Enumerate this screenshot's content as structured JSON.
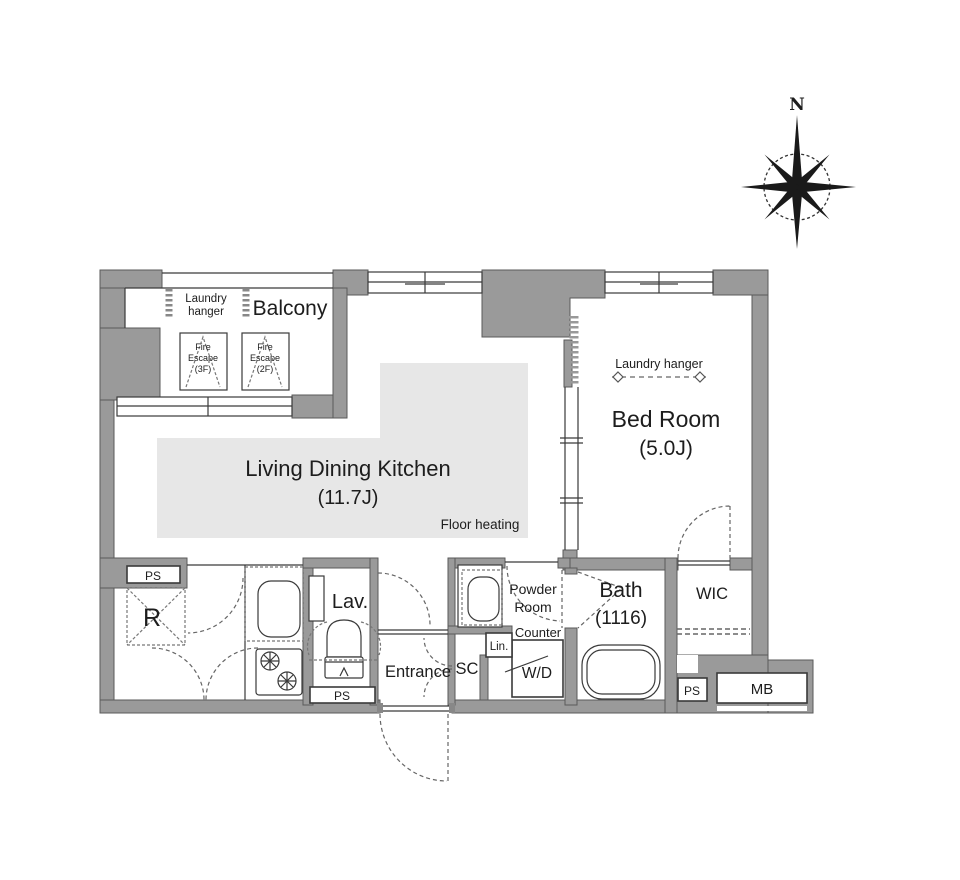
{
  "compass": {
    "north_label": "N"
  },
  "colors": {
    "wall": "#9a9a9a",
    "floor_heating": "#e7e7e7",
    "line": "#3a3a3a"
  },
  "balcony": {
    "label": "Balcony",
    "laundry_line1": "Laundry",
    "laundry_line2": "hanger",
    "fire_escape_3f": {
      "line1": "Fire",
      "line2": "Escape",
      "line3": "(3F)"
    },
    "fire_escape_2f": {
      "line1": "Fire",
      "line2": "Escape",
      "line3": "(2F)"
    }
  },
  "ldk": {
    "name": "Living Dining Kitchen",
    "size": "(11.7J)",
    "floor_heating": "Floor heating"
  },
  "bedroom": {
    "name": "Bed Room",
    "size": "(5.0J)",
    "laundry_hanger": "Laundry hanger"
  },
  "rooms": {
    "lav": "Lav.",
    "entrance": "Entrance",
    "sc": "SC",
    "lin": "Lin.",
    "powder_line1": "Powder",
    "powder_line2": "Room",
    "counter": "Counter",
    "wd": "W/D",
    "bath": "Bath",
    "bath_size": "(1116)",
    "wic": "WIC",
    "refrigerator": "R",
    "mb": "MB",
    "ps": "PS"
  }
}
